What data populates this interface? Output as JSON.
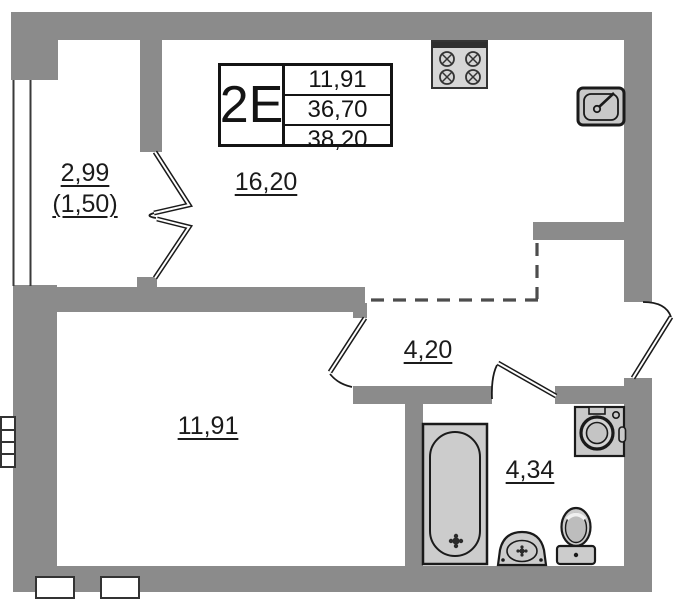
{
  "title_block": {
    "unit_type": "2E",
    "areas": [
      "11,91",
      "36,70",
      "38,20"
    ]
  },
  "rooms": {
    "living_kitchen": {
      "area_label": "16,20"
    },
    "room": {
      "area_label": "11,91"
    },
    "hallway": {
      "area_label": "4,20"
    },
    "bathroom": {
      "area_label": "4,34"
    },
    "balcony": {
      "area_label": "2,99",
      "area_label_secondary": "(1,50)"
    }
  },
  "fixtures": [
    "stove-icon",
    "kitchen-sink-icon",
    "bathtub-icon",
    "washbasin-icon",
    "toilet-icon",
    "washing-machine-icon",
    "balcony-door",
    "room-door",
    "bathroom-door",
    "entry-door"
  ],
  "colors": {
    "background": "#ffffff",
    "wall": "#8b8b8b",
    "fixture_fill": "#cacaca",
    "line": "#1a1a1a",
    "dashed_line": "#4d4d4d"
  }
}
